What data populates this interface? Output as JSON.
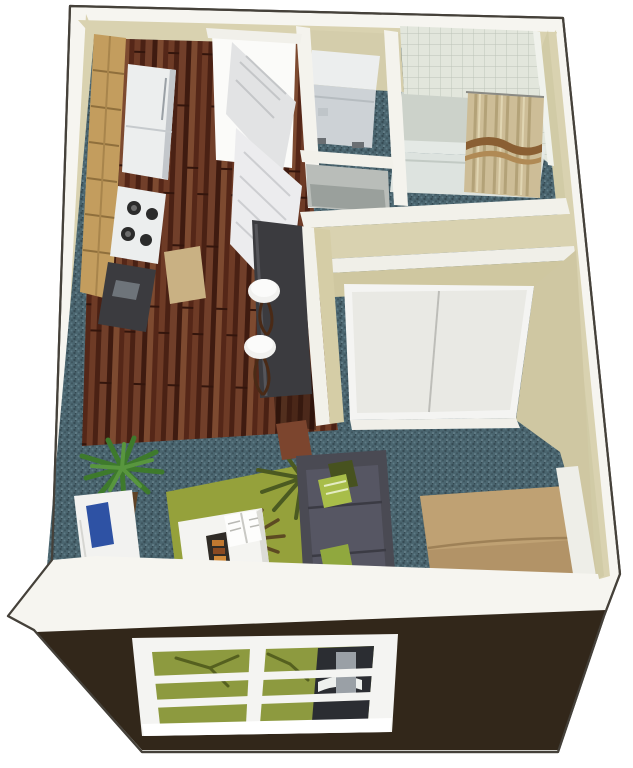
{
  "scene": {
    "title": "Studio Apartment 3D Floor Plan",
    "type": "3d-isometric-floor-plan-render",
    "visible_text": [],
    "rooms": [
      {
        "id": "kitchen",
        "label": "Kitchen"
      },
      {
        "id": "entry",
        "label": "Entry Hall"
      },
      {
        "id": "laundry-closet",
        "label": "Laundry Closet"
      },
      {
        "id": "linen-closet",
        "label": "Linen Closet"
      },
      {
        "id": "bathroom",
        "label": "Bathroom"
      },
      {
        "id": "wardrobe-closet",
        "label": "Wardrobe Closet with Sliding Doors"
      },
      {
        "id": "breakfast-bar",
        "label": "Breakfast Bar"
      },
      {
        "id": "living-sleeping",
        "label": "Living / Sleeping Area"
      }
    ],
    "furniture": [
      "upper-and-lower-wood-cabinets",
      "refrigerator",
      "stove-with-burners",
      "kitchen-counter",
      "kitchen-mat",
      "open-entry-doors",
      "bar-counter",
      "two-bar-stools",
      "stacked-washer-dryer",
      "bathtub-shower",
      "striped-shower-curtain",
      "sliding-closet-doors",
      "potted-plant",
      "media-console-with-blue-object",
      "green-palm-area-rug",
      "white-coffee-table",
      "magazine",
      "snack-tray",
      "end-table",
      "charcoal-sofa-with-green-pillows",
      "tan-bed",
      "front-window"
    ]
  },
  "palette": {
    "page_bg": "#ffffff",
    "wall_top_white": "#f6f5f0",
    "outline_dark": "#45413a",
    "wall_cream": "#d9d2b0",
    "wall_cream_shade": "#cbc49e",
    "hardwood_base": "#5b2b1c",
    "carpet_teal": "#4a656f",
    "tile_bg": "#e2e6dc",
    "tile_line": "#bcc3b7",
    "tub_white": "#e4e9e5",
    "curtain_tan": "#cdbd97",
    "curtain_stripe": "#8a5f33",
    "appliance_white": "#eceeee",
    "appliance_gray": "#cdd2d6",
    "cabinet_wood": "#c39d5e",
    "cabinet_wood_dark": "#8f6f3c",
    "counter_dark": "#3b3b3f",
    "stool_white": "#f1f1ef",
    "stool_leg_brown": "#4a2a16",
    "rug_green": "#95a13b",
    "frond_dark": "#4b5a21",
    "sofa_charcoal": "#4a4a53",
    "pillow_green": "#a8bd49",
    "bed_tan": "#b29367",
    "bed_tan_light": "#bfa173",
    "plant_green": "#3e7a2c",
    "plant_green_light": "#58963e",
    "pot_brown": "#5f4226",
    "front_wall_brown": "#32271a",
    "window_frame_white": "#f4f4f2",
    "blue_object": "#2e52a4",
    "end_table_rust": "#7c452e",
    "door_leaf_gray": "#e2e3e4",
    "closet_door_white": "#e9e9e4"
  },
  "window": {
    "panes": 2,
    "rails_per_pane": 2,
    "location": "front-exterior-wall"
  }
}
